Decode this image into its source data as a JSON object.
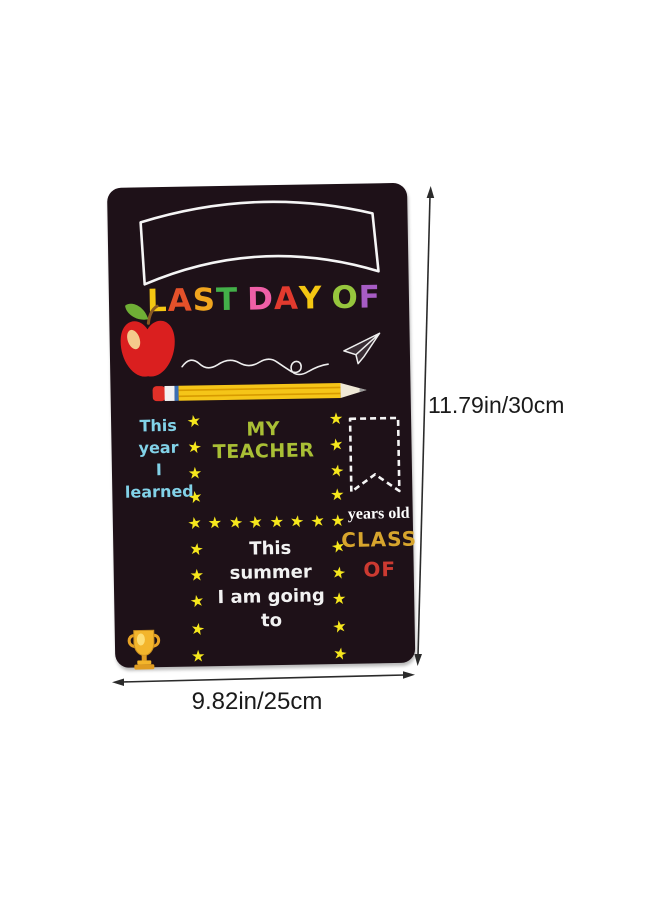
{
  "board": {
    "title": {
      "text": "LAST DAY OF",
      "letters": [
        {
          "ch": "L",
          "color": "#f4c712"
        },
        {
          "ch": "A",
          "color": "#e4512a"
        },
        {
          "ch": "S",
          "color": "#f0a51e"
        },
        {
          "ch": "T",
          "color": "#43b049"
        },
        {
          "ch": " ",
          "color": ""
        },
        {
          "ch": "D",
          "color": "#ef5fa7"
        },
        {
          "ch": "A",
          "color": "#e23a2e"
        },
        {
          "ch": "Y",
          "color": "#f4c712"
        },
        {
          "ch": " ",
          "color": ""
        },
        {
          "ch": "O",
          "color": "#96c63d"
        },
        {
          "ch": "F",
          "color": "#a75cc4"
        }
      ]
    },
    "this_year_line1": "This year",
    "this_year_line2": "I learned",
    "teacher_label": "MY TEACHER",
    "years_old_label": "years old",
    "class_label": "CLASS",
    "of_label": "OF",
    "summer_line1": "This summer",
    "summer_line2": "I am going to",
    "star_glyph": "★",
    "colors": {
      "board_bg": "#1e1118",
      "star": "#f6e71d",
      "this_year_text": "#82d2e8",
      "teacher_text": "#a9bf35",
      "class_text": "#d7a52d",
      "of_text": "#cc3a31",
      "summer_text": "#f2f2f2",
      "years_old_text": "#ffffff",
      "chalk_line": "#f5f5f5"
    }
  },
  "annotations": {
    "height_label": "11.79in/30cm",
    "width_label": "9.82in/25cm"
  }
}
